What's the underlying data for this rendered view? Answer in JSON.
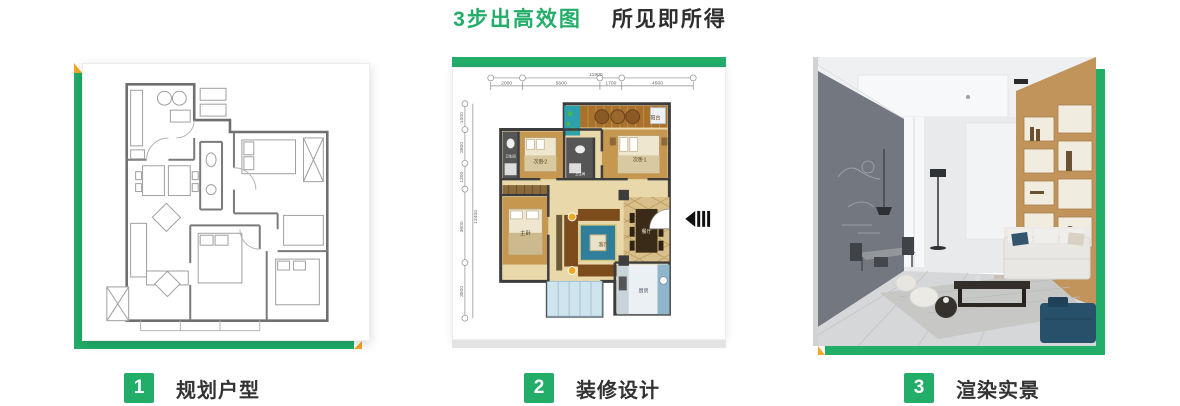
{
  "title": {
    "highlight": "3步出高效图",
    "rest": "所见即所得"
  },
  "colors": {
    "green": "#22ad69",
    "orange": "#f6a623",
    "dark": "#333333"
  },
  "steps": [
    {
      "number": "1",
      "label": "规划户型"
    },
    {
      "number": "2",
      "label": "装修设计"
    },
    {
      "number": "3",
      "label": "渲染实景"
    }
  ],
  "colored_plan": {
    "total_top": "11900",
    "dims_top": [
      "2000",
      "5600",
      "1700",
      "4500"
    ],
    "total_left": "12400",
    "dims_left": [
      "1000",
      "2800",
      "1300",
      "3600",
      "3500"
    ],
    "rooms": {
      "balcony": "阳台",
      "bedroom1": "次卧1",
      "bedroom2": "次卧2",
      "master": "主卧",
      "living": "客厅",
      "dining": "餐厅",
      "kitchen": "厨房",
      "bath": "卫生间"
    }
  }
}
